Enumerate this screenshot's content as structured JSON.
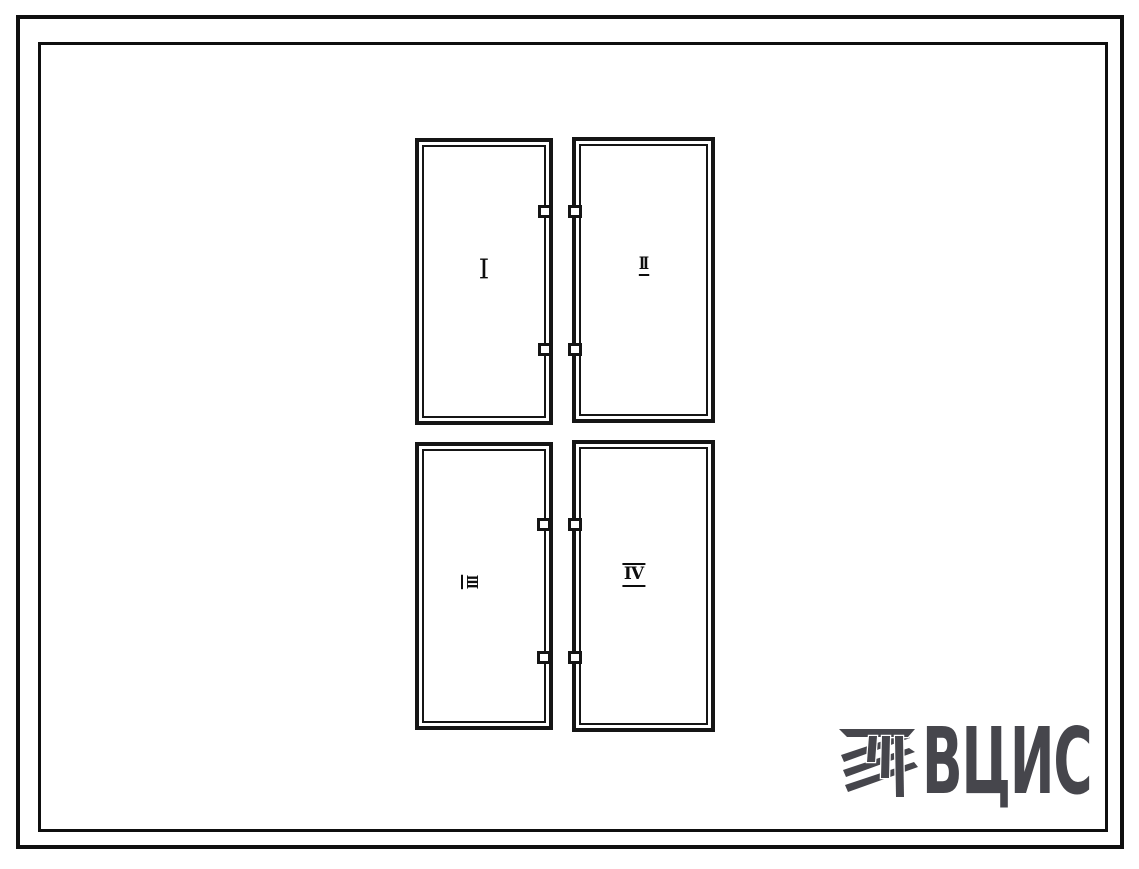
{
  "sheet": {
    "background_color": "#ffffff",
    "line_color": "#151515",
    "frame_style": "double-border drawing sheet"
  },
  "diagram": {
    "type": "facade-panel-layout",
    "panels": [
      {
        "id": "panel-1",
        "label": "I",
        "position": "top-left"
      },
      {
        "id": "panel-2",
        "label": "II",
        "position": "top-right"
      },
      {
        "id": "panel-3",
        "label": "III",
        "position": "bottom-left"
      },
      {
        "id": "panel-4",
        "label": "IV",
        "position": "bottom-right"
      }
    ],
    "joint_tabs_per_gap": 4
  },
  "logo": {
    "text": "ВЦИС",
    "color": "#46464c",
    "icon": "hatched-monogram-icon"
  }
}
